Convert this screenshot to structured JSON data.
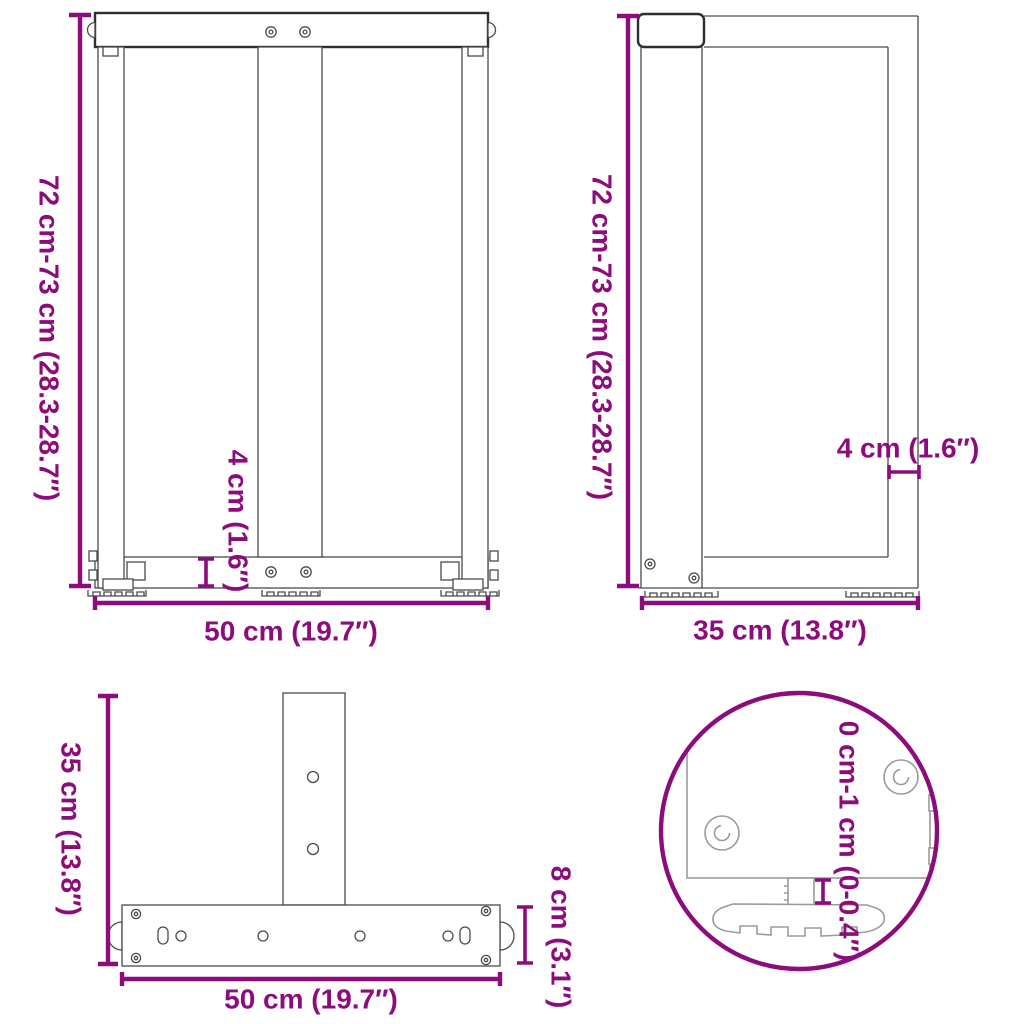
{
  "colors": {
    "accent": "#8C0C7C",
    "line": "#4A4A4A",
    "line_dark": "#2E2E2E",
    "line_light": "#9B9B9B",
    "bg": "#FFFFFF"
  },
  "views": {
    "front": {
      "height": "72 cm-73 cm (28.3-28.7″)",
      "plate_thickness": "4 cm (1.6″)",
      "width": "50 cm (19.7″)"
    },
    "side": {
      "height": "72 cm-73 cm (28.3-28.7″)",
      "wall_thickness": "4 cm (1.6″)",
      "depth": "35 cm (13.8″)"
    },
    "top": {
      "depth": "35 cm (13.8″)",
      "width": "50 cm (19.7″)",
      "bar_width": "8 cm (3.1″)"
    },
    "detail": {
      "adjust_range": "0 cm-1 cm (0-0.4″)"
    }
  }
}
